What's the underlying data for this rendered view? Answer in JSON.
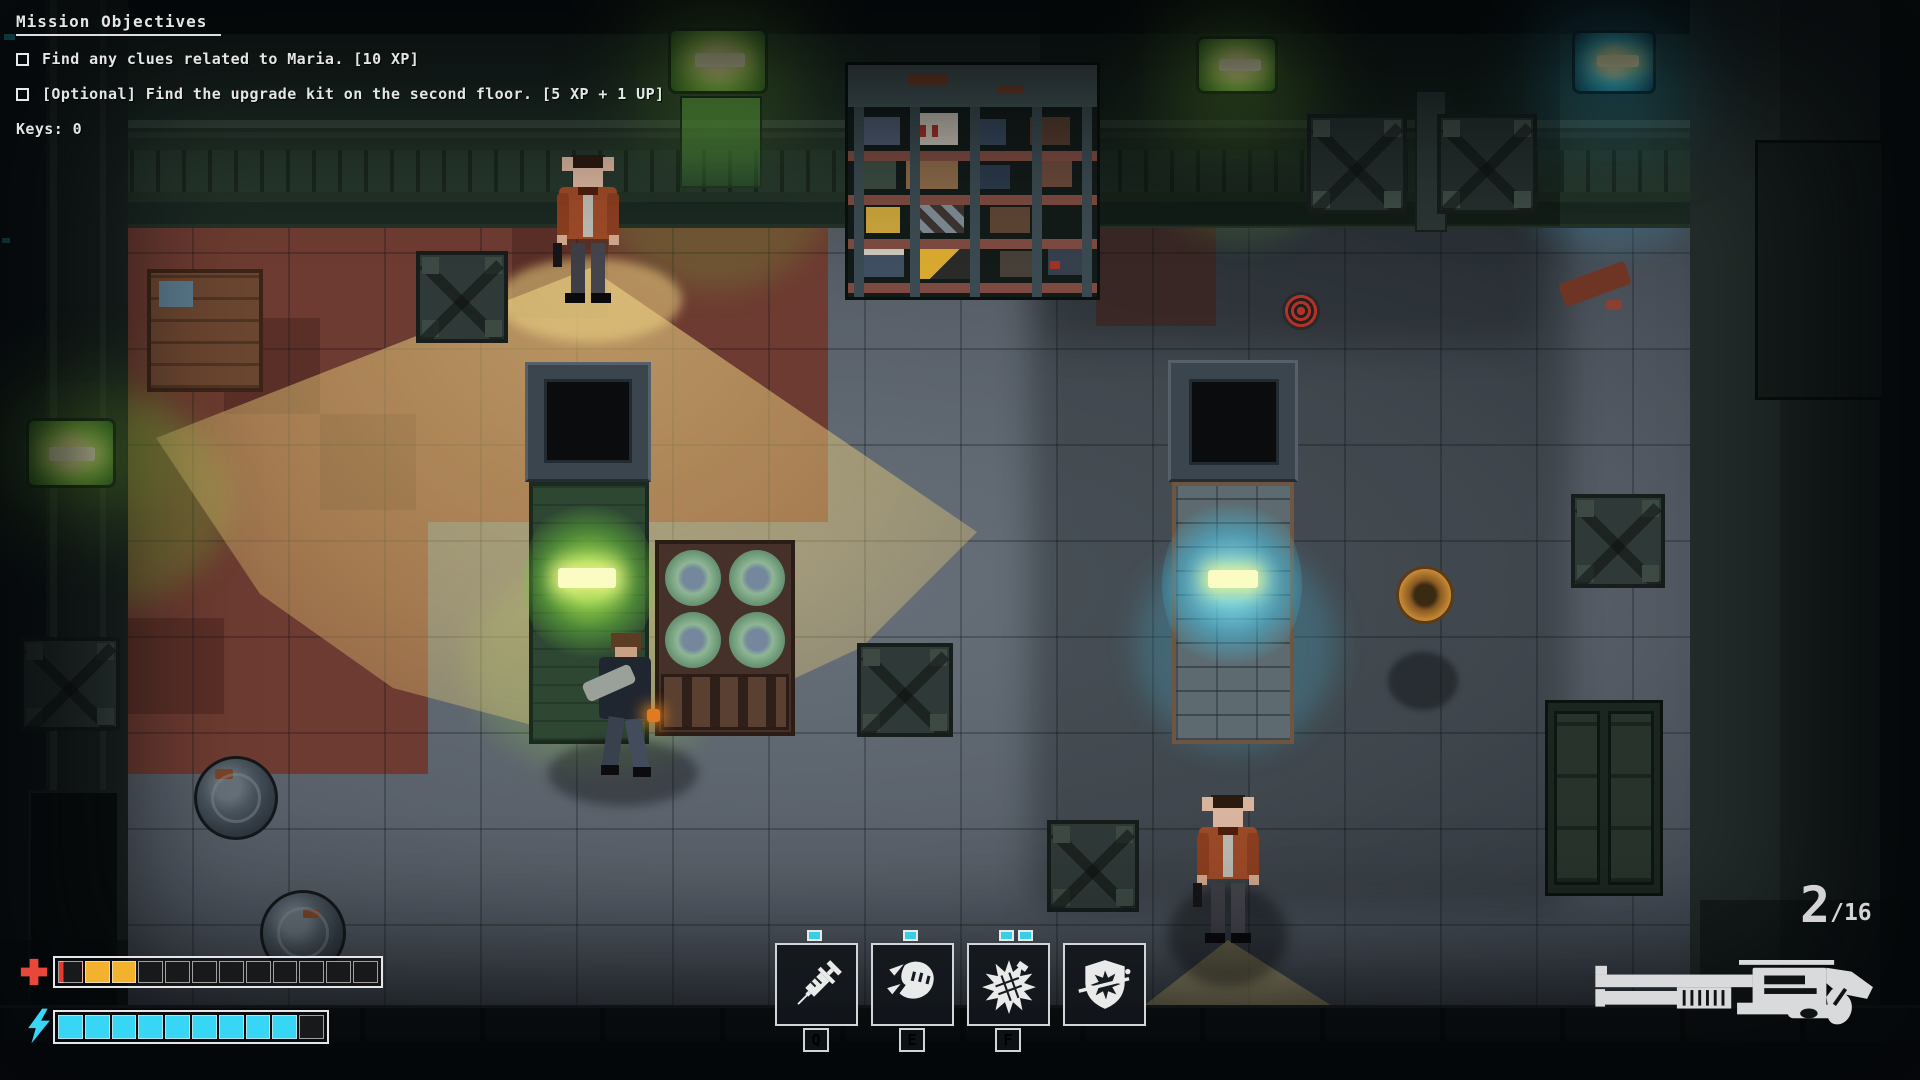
{
  "theme": {
    "health_full": "#f2b22e",
    "health_damage": "#e8392e",
    "energy": "#38d6f5",
    "hud_text": "#e4e6e6",
    "cone": "rgba(236,206,122,0.52)"
  },
  "hud": {
    "objectives": {
      "title": "Mission Objectives",
      "items": [
        {
          "text": "Find any clues related to Maria. [10 XP]",
          "checked": false
        },
        {
          "text": "[Optional] Find the upgrade kit on the second floor. [5 XP + 1 UP]",
          "checked": false
        }
      ],
      "keys": "Keys: 0"
    },
    "health": {
      "icon": "health-cross-icon",
      "segments": [
        "partial",
        "full",
        "full",
        "empty",
        "empty",
        "empty",
        "empty",
        "empty",
        "empty",
        "empty",
        "empty",
        "empty"
      ]
    },
    "energy": {
      "icon": "energy-bolt-icon",
      "segments": [
        "full",
        "full",
        "full",
        "full",
        "full",
        "full",
        "full",
        "full",
        "full",
        "empty"
      ]
    },
    "abilities": {
      "slots": [
        {
          "icon": "syringe-icon",
          "key": "Q",
          "charges": 1
        },
        {
          "icon": "fist-icon",
          "key": "E",
          "charges": 1
        },
        {
          "icon": "spiked-grenade-icon",
          "key": "F",
          "charges": 2
        },
        {
          "icon": "shield-parry-icon",
          "key": "",
          "charges": 0
        }
      ]
    },
    "ammo": {
      "current": "2",
      "reserve": "/16",
      "weapon": "shotgun"
    }
  }
}
